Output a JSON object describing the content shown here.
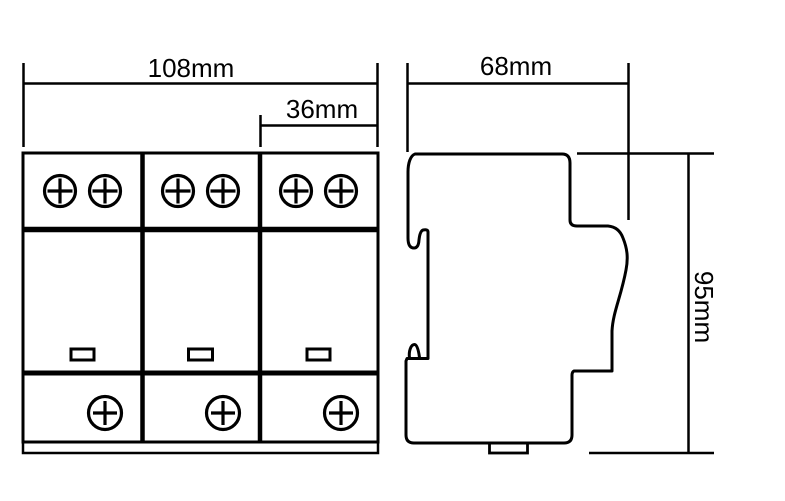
{
  "colors": {
    "line": "#000000",
    "background": "#ffffff"
  },
  "front_view": {
    "module_count": 3,
    "top_screws_per_module": 2,
    "bottom_screws_per_module": 1,
    "indicator_windows": 3,
    "dim_overall_width": "108mm",
    "dim_module_width": "36mm"
  },
  "side_view": {
    "dim_depth": "68mm",
    "dim_height": "95mm"
  }
}
